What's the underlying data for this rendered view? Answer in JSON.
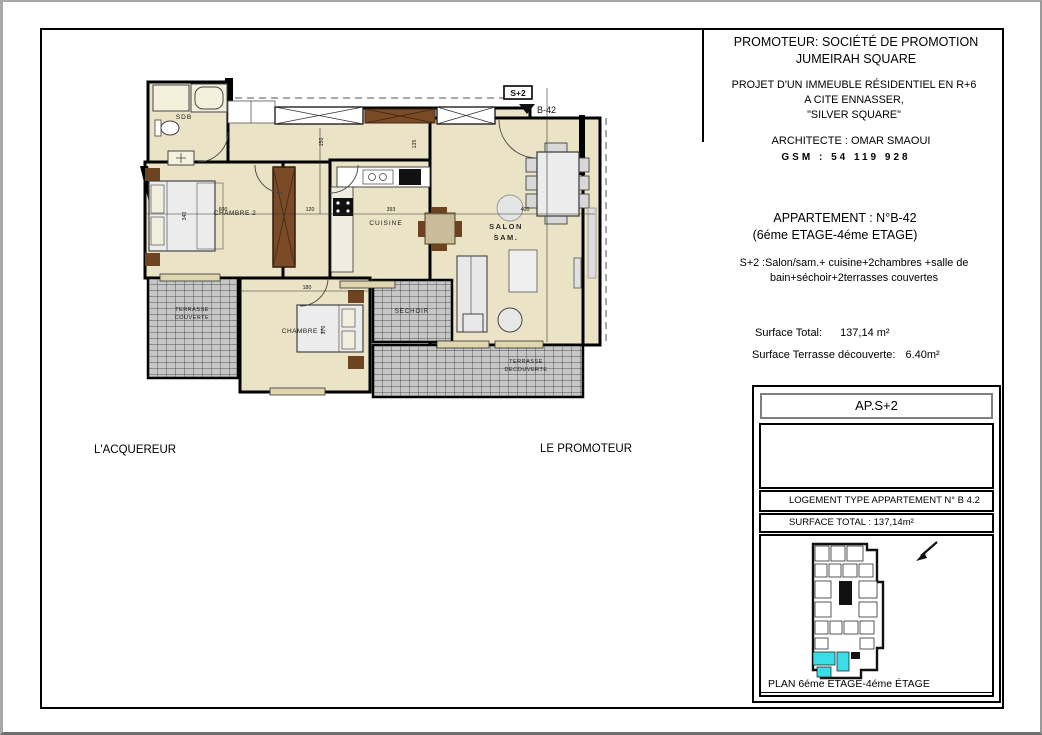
{
  "header": {
    "promoter_label": "PROMOTEUR:  SOCIÉTÉ DE PROMOTION",
    "promoter_name": "JUMEIRAH SQUARE",
    "project_line1": "PROJET D'UN IMMEUBLE RÉSIDENTIEL EN  R+6",
    "project_line2": "A CITE ENNASSER,",
    "project_line3": "\"SILVER SQUARE\"",
    "architect_line": "ARCHITECTE :    OMAR SMAOUI",
    "gsm_line": "GSM : 54 119 928"
  },
  "apartment": {
    "title": "APPARTEMENT : N°B-42",
    "floors": "(6éme ETAGE-4éme ETAGE)",
    "type_line1": "S+2 :Salon/sam.+ cuisine+2chambres +salle de",
    "type_line2": "bain+séchoir+2terrasses couvertes",
    "surface_total_label": "Surface Total:",
    "surface_total_value": "137,14 m²",
    "surface_terrace_label": "Surface Terrasse découverte:",
    "surface_terrace_value": "6.40m²"
  },
  "signatures": {
    "buyer": "L'ACQUEREUR",
    "promoter": "LE PROMOTEUR"
  },
  "title_block": {
    "ap_code": "AP.S+2",
    "logement_type": "LOGEMENT TYPE APPARTEMENT N° B 4.2",
    "surface_total": "SURFACE TOTAL : 137,14m²",
    "plan_caption": "PLAN 6éme ETAGE-4éme ÉTAGE"
  },
  "plan": {
    "unit_tag": "S+2",
    "unit_ref": "B-42",
    "rooms": {
      "sdb": "SDB",
      "chambre2": "CHAMBRE 2",
      "cuisine": "CUISINE",
      "salon_line1": "SALON",
      "salon_line2": "SAM.",
      "chambre1": "CHAMBRE 1",
      "sechoir": "SECHOIR",
      "terr_couv_line1": "TERRASSE",
      "terr_couv_line2": "COUVERTE",
      "terr_dec_line1": "TERRASSE",
      "terr_dec_line2": "DECOUVERTE"
    },
    "dims": [
      "600",
      "120",
      "393",
      "400",
      "340",
      "135",
      "150",
      "180",
      "370"
    ],
    "colors": {
      "floor_beige": "#EBE3C6",
      "wall_black": "#000000",
      "wood_brown": "#7B4A26",
      "hatch_grey": "#C6C6C6",
      "furniture_grey": "#E6E6E6",
      "highlight_cyan": "#3ADEE8"
    }
  }
}
